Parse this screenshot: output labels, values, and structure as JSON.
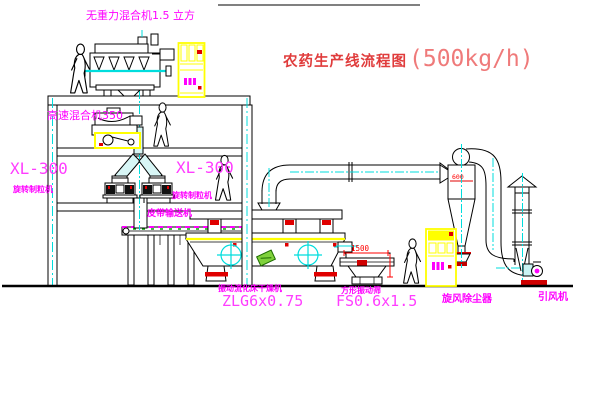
{
  "diagram": {
    "title": {
      "name": "农药生产线流程图",
      "capacity": "(500kg/h)"
    },
    "equipment": {
      "gravity_mixer": {
        "label": "无重力混合机1.5 立方"
      },
      "high_speed_mixer": {
        "label": "高速混合机350"
      },
      "granulator_left": {
        "model": "XL-300",
        "name": "旋转制粒机"
      },
      "granulator_right": {
        "model": "XL-300",
        "name": "旋转制粒机"
      },
      "belt_conveyor": {
        "name": "皮带输送机"
      },
      "fluid_bed_dryer": {
        "name": "振动流化床干燥机",
        "model": "ZLG6x0.75"
      },
      "vibrating_sieve": {
        "name": "方形振动筛",
        "model": "FS0.6x1.5",
        "dimension": "1500"
      },
      "cyclone": {
        "name": "旋风除尘器",
        "dimension": "600"
      },
      "induced_draft_fan": {
        "name": "引风机"
      }
    },
    "colors": {
      "line": "#000000",
      "label_magenta": "#ff00ff",
      "dimension_red": "#ff0000",
      "centerline_cyan": "#00dddd",
      "cabinet_yellow": "#ffff00",
      "title_red": "#e03c3c",
      "pipe_fill": "#d8f6f6",
      "green": "#7fd13b"
    }
  }
}
